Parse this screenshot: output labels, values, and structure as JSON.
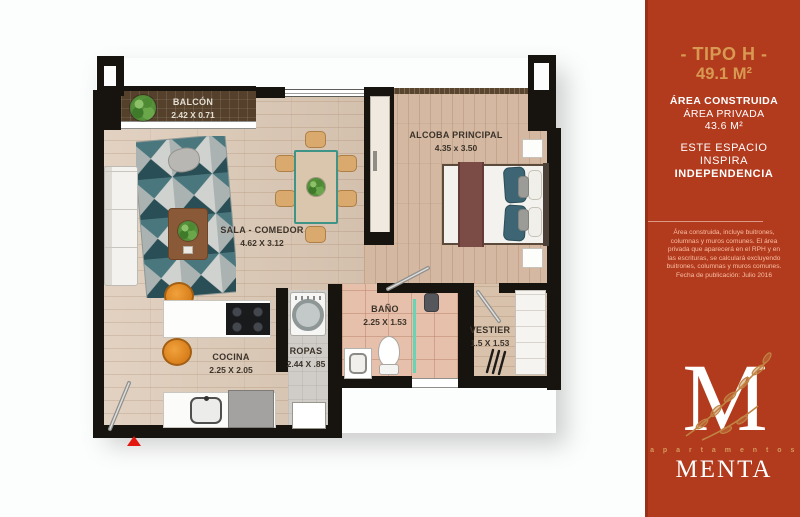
{
  "sidebar": {
    "title": "- TIPO H -",
    "area_total": "49.1 M²",
    "area_construida_label": "ÁREA CONSTRUIDA",
    "area_privada_label": "ÁREA PRIVADA",
    "area_privada_value": "43.6 M²",
    "tagline_line1": "ESTE ESPACIO",
    "tagline_line2": "INSPIRA",
    "tagline_line3": "INDEPENDENCIA",
    "disclaimer_lines": [
      "Área construida, incluye buitrones,",
      "columnas y muros comunes. El área",
      "privada que aparecerá en el RPH y en",
      "las escrituras, se calculará excluyendo",
      "buitrones, columnas y muros comunes.",
      "Fecha de publicación:  Julio 2016"
    ],
    "logo": {
      "monogram": "M",
      "brand_top": "a p a r t a m e n t o s",
      "brand_name": "MENTA"
    },
    "colors": {
      "background": "#b23a1d",
      "accent_gold": "#d89a52"
    }
  },
  "rooms": {
    "balcon": {
      "name": "BALCÓN",
      "dims": "2.42 X 0.71"
    },
    "alcoba": {
      "name": "ALCOBA PRINCIPAL",
      "dims": "4.35 x 3.50"
    },
    "sala": {
      "name": "SALA - COMEDOR",
      "dims": "4.62 X 3.12"
    },
    "cocina": {
      "name": "COCINA",
      "dims": "2.25 X 2.05"
    },
    "ropas": {
      "name": "ROPAS",
      "dims": "2.44 X .85"
    },
    "bano": {
      "name": "BAÑO",
      "dims": "2.25 X 1.53"
    },
    "vestier": {
      "name": "VESTIER",
      "dims": "1.5 X 1.53"
    }
  },
  "plan": {
    "entrance_marker_color": "#e3170f",
    "wall_color": "#17130e"
  }
}
